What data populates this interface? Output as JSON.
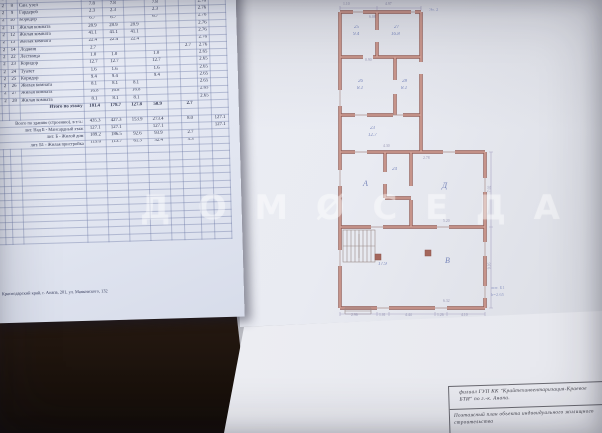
{
  "left_page": {
    "table": {
      "header": [
        "1",
        "2",
        "3",
        "4",
        "5",
        "6",
        "7",
        "8",
        "9",
        "10",
        "11",
        "12"
      ],
      "rows": [
        [
          "Б",
          "2",
          "7",
          "Лестница",
          "6.9",
          "6.9",
          "",
          "6.9",
          "",
          "",
          "2.76",
          ""
        ],
        [
          "Б",
          "2",
          "8",
          "Сан. узел",
          "7.8",
          "7.8",
          "",
          "7.8",
          "",
          "",
          "2.76",
          ""
        ],
        [
          "Б",
          "2",
          "9",
          "Гардероб",
          "2.3",
          "2.3",
          "",
          "2.3",
          "",
          "",
          "2.76",
          ""
        ],
        [
          "Б",
          "2",
          "10",
          "Коридор",
          "6.7",
          "6.7",
          "",
          "6.7",
          "",
          "",
          "2.76",
          ""
        ],
        [
          "Б",
          "2",
          "11",
          "Жилая комната",
          "28.9",
          "28.9",
          "28.9",
          "",
          "",
          "",
          "2.76",
          ""
        ],
        [
          "Б",
          "2",
          "12",
          "Жилая комната",
          "41.1",
          "41.1",
          "41.1",
          "",
          "",
          "",
          "2.76",
          ""
        ],
        [
          "Б",
          "2",
          "13",
          "Жилая комната",
          "22.4",
          "22.4",
          "22.4",
          "",
          "",
          "",
          "2.76",
          ""
        ],
        [
          "Б",
          "2",
          "14",
          "Лоджия",
          "2.7",
          "",
          "",
          "",
          "",
          "2.7",
          "2.76",
          ""
        ],
        [
          "Б1",
          "2",
          "22",
          "Лестница",
          "1.0",
          "1.0",
          "",
          "1.0",
          "",
          "",
          "2.65",
          ""
        ],
        [
          "Б1",
          "2",
          "23",
          "Коридор",
          "12.7",
          "12.7",
          "",
          "12.7",
          "",
          "",
          "2.65",
          ""
        ],
        [
          "Б1",
          "2",
          "24",
          "Туалет",
          "1.6",
          "1.6",
          "",
          "1.6",
          "",
          "",
          "2.65",
          ""
        ],
        [
          "Б1",
          "2",
          "25",
          "Коридор",
          "9.4",
          "9.4",
          "",
          "9.4",
          "",
          "",
          "2.65",
          ""
        ],
        [
          "Б1",
          "2",
          "26",
          "Жилая комната",
          "8.1",
          "8.1",
          "8.1",
          "",
          "",
          "",
          "2.65",
          ""
        ],
        [
          "Б1",
          "2",
          "27",
          "Жилая комната",
          "16.8",
          "16.8",
          "16.8",
          "",
          "",
          "",
          "2.65",
          ""
        ],
        [
          "Б1",
          "2",
          "28",
          "Жилая комната",
          "8.1",
          "8.1",
          "8.1",
          "",
          "",
          "",
          "2.65",
          ""
        ]
      ],
      "total": [
        "",
        "",
        "",
        "Итого по этажу",
        "181.4",
        "178.7",
        "127.8",
        "50.9",
        "",
        "2.7",
        "",
        ""
      ],
      "summary": [
        [
          "Всего по зданию (строению), в т.ч.:",
          "435.3",
          "427.3",
          "153.9",
          "273.4",
          "8.0",
          "127.1"
        ],
        [
          "лит. Над Б - Мансардный этаж",
          "127.1",
          "127.1",
          "",
          "127.1",
          "",
          "127.1"
        ],
        [
          "лит. Б - Жилой дом",
          "189.2",
          "186.5",
          "92.6",
          "93.9",
          "2.7",
          ""
        ],
        [
          "лит. Б1 - Жилая пристройка",
          "119.0",
          "113.7",
          "61.3",
          "52.4",
          "5.3",
          ""
        ]
      ],
      "empty_rows": [
        "",
        "",
        "",
        "",
        "",
        "",
        "",
        "",
        "",
        "",
        "",
        "",
        ""
      ]
    },
    "footer": "Краснодарский край, г. Анапа, 201, ул. Маяковского, 132"
  },
  "right_page": {
    "plan": {
      "labels": [
        {
          "t": "25",
          "st": "left:29px;top:23px",
          "c": "plan-label room"
        },
        {
          "t": "9.4",
          "st": "left:28px;top:30px",
          "c": "plan-label room"
        },
        {
          "t": "27",
          "st": "left:69px;top:23px",
          "c": "plan-label room"
        },
        {
          "t": "16.8",
          "st": "left:66px;top:30px",
          "c": "plan-label room"
        },
        {
          "t": "26",
          "st": "left:33px;top:77px",
          "c": "plan-label room"
        },
        {
          "t": "8.1",
          "st": "left:32px;top:84px",
          "c": "plan-label room"
        },
        {
          "t": "28",
          "st": "left:77px;top:77px",
          "c": "plan-label room"
        },
        {
          "t": "8.1",
          "st": "left:76px;top:84px",
          "c": "plan-label room"
        },
        {
          "t": "23",
          "st": "left:45px;top:124px",
          "c": "plan-label room"
        },
        {
          "t": "12.7",
          "st": "left:43px;top:131px",
          "c": "plan-label room"
        },
        {
          "t": "24",
          "st": "left:67px;top:165px",
          "c": "plan-label room"
        },
        {
          "t": "А",
          "st": "left:38px;top:178px",
          "c": "plan-label big"
        },
        {
          "t": "Д",
          "st": "left:117px;top:180px",
          "c": "plan-label big"
        },
        {
          "t": "17.9",
          "st": "left:53px;top:260px",
          "c": "plan-label room"
        },
        {
          "t": "В",
          "st": "left:120px;top:255px",
          "c": "plan-label big"
        },
        {
          "t": "Эт. 2",
          "st": "left:104px;top:6px",
          "c": "plan-label note"
        },
        {
          "t": "лит. Б1",
          "st": "left:166px;top:284px",
          "c": "plan-label note"
        },
        {
          "t": "h=2.65",
          "st": "left:166px;top:291px",
          "c": "plan-label note"
        },
        {
          "t": "1.10",
          "st": "left:18px;top:1px",
          "c": "plan-label dim"
        },
        {
          "t": "4.97",
          "st": "left:60px;top:1px",
          "c": "plan-label dim"
        },
        {
          "t": "6.08",
          "st": "left:44px;top:14px",
          "c": "plan-label dim"
        },
        {
          "t": "2.96",
          "st": "left:26px;top:312px",
          "c": "plan-label dim"
        },
        {
          "t": "1.01",
          "st": "left:54px;top:312px",
          "c": "plan-label dim"
        },
        {
          "t": "4.44",
          "st": "left:80px;top:312px",
          "c": "plan-label dim"
        },
        {
          "t": "1.26",
          "st": "left:112px;top:312px",
          "c": "plan-label dim"
        },
        {
          "t": "4.10",
          "st": "left:136px;top:312px",
          "c": "plan-label dim"
        },
        {
          "t": "7.02",
          "st": "left:162px;top:185px;transform:rotate(-90deg)",
          "c": "plan-label dim"
        },
        {
          "t": "9.16",
          "st": "left:162px;top:262px;transform:rotate(-90deg)",
          "c": "plan-label dim"
        },
        {
          "t": "4.30",
          "st": "left:58px;top:143px",
          "c": "plan-label dim"
        },
        {
          "t": "2.78",
          "st": "left:98px;top:155px",
          "c": "plan-label dim"
        },
        {
          "t": "5.20",
          "st": "left:118px;top:218px",
          "c": "plan-label dim"
        },
        {
          "t": "6.32",
          "st": "left:118px;top:298px",
          "c": "plan-label dim"
        },
        {
          "t": "0.90",
          "st": "left:40px;top:57px",
          "c": "plan-label dim"
        }
      ]
    },
    "stamp": {
      "org_line1": "филиал ГУП КК \"Крайтехинвентаризация-Краевое",
      "org_line2": "БТИ\" по г.-к. Анапа.",
      "title_line1": "Поэтажный план объекта индивидуального жилищного",
      "title_line2": "строительства"
    }
  },
  "watermark": {
    "letters": [
      "Д",
      "О",
      "М",
      "Ø",
      "С",
      "Е",
      "Д",
      "А"
    ]
  }
}
